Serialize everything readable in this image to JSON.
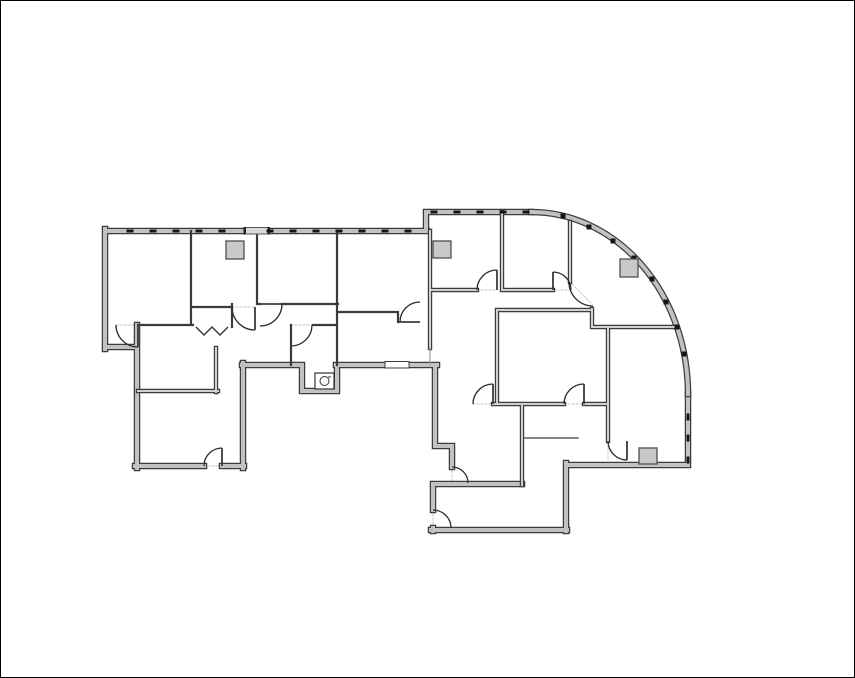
{
  "palette": {
    "background": "#ffffff",
    "image_border": "#000000",
    "wall_edge": "#3d3d3d",
    "wall_fill": "#c2c2c2",
    "partition_fill": "#d0d0d0",
    "wall_minor": "#3b3b3b",
    "hairline": "#3b3b3b",
    "light_wall": "#9b9b9b",
    "door": "#2b2b2b",
    "threshold": "#c6c6c6",
    "tick": "#161616",
    "column_fill": "#c9c9c9",
    "column_edge": "#4f4f4f",
    "fixture": "#333333",
    "recess_fill": "#d9d9d9",
    "recess_cap": "#222222"
  },
  "floorplan": {
    "canvas": {
      "width": 855,
      "height": 678
    },
    "walls_exterior": [
      [
        105,
        231,
        245,
        231
      ],
      [
        268,
        231,
        427,
        231
      ],
      [
        105,
        229,
        105,
        349
      ],
      [
        105,
        347,
        137,
        347
      ],
      [
        137,
        325,
        137,
        468
      ],
      [
        135,
        466,
        204,
        466
      ],
      [
        222,
        466,
        244,
        466
      ],
      [
        243,
        363,
        243,
        468
      ],
      [
        242,
        365,
        302,
        365
      ],
      [
        302,
        365,
        302,
        391
      ],
      [
        302,
        391,
        337,
        391
      ],
      [
        337,
        391,
        337,
        365
      ],
      [
        336,
        365,
        437,
        365
      ],
      [
        435,
        365,
        435,
        446
      ],
      [
        435,
        446,
        452,
        446
      ],
      [
        452,
        446,
        452,
        467
      ],
      [
        433,
        484,
        522,
        484
      ],
      [
        433,
        484,
        433,
        510
      ],
      [
        433,
        528,
        433,
        531
      ],
      [
        431,
        530,
        567,
        530
      ],
      [
        566,
        463,
        566,
        531
      ],
      [
        566,
        465,
        688,
        465
      ],
      [
        688,
        394,
        688,
        465
      ],
      [
        426,
        212,
        531,
        212
      ],
      [
        426,
        212,
        426,
        231
      ]
    ],
    "curve_path": "M531,212 A157,182 0 0 1 688,394",
    "walls_major": [
      [
        430,
        231,
        430,
        348
      ],
      [
        522,
        404,
        522,
        485
      ],
      [
        430,
        290,
        477,
        290
      ],
      [
        504,
        290,
        553,
        290
      ],
      [
        502,
        212,
        502,
        290
      ],
      [
        570,
        222,
        570,
        282
      ],
      [
        592,
        309,
        592,
        327
      ],
      [
        497,
        310,
        592,
        310
      ],
      [
        497,
        310,
        497,
        404
      ],
      [
        493,
        404,
        564,
        404
      ],
      [
        584,
        404,
        608,
        404
      ],
      [
        608,
        327,
        608,
        441
      ],
      [
        592,
        327,
        677,
        327
      ],
      [
        138,
        391,
        218,
        391
      ],
      [
        216,
        348,
        216,
        392
      ]
    ],
    "walls_minor": [
      [
        191,
        231,
        191,
        325
      ],
      [
        138,
        325,
        193,
        325
      ],
      [
        193,
        307,
        232,
        307
      ],
      [
        232,
        304,
        232,
        327
      ],
      [
        257,
        231,
        257,
        304
      ],
      [
        257,
        304,
        260,
        304
      ],
      [
        282,
        304,
        338,
        304
      ],
      [
        337,
        231,
        337,
        365
      ],
      [
        338,
        312,
        398,
        312
      ],
      [
        398,
        312,
        398,
        322
      ],
      [
        291,
        325,
        291,
        365
      ],
      [
        313,
        325,
        337,
        325
      ]
    ],
    "walls_hairline": [
      [
        525,
        438,
        578,
        438
      ]
    ],
    "walls_light": [
      [
        430,
        348,
        430,
        364
      ]
    ],
    "glass_panel": {
      "x": 385,
      "y": 361.5,
      "w": 24,
      "h": 6.5
    },
    "entry_recess": {
      "x": 245,
      "y": 227.5,
      "w": 23,
      "h": 6.5,
      "caps": [
        [
          243.5,
          227,
          2.5,
          7.5
        ],
        [
          267.5,
          227,
          2.5,
          7.5
        ]
      ]
    },
    "doors": [
      {
        "id": "door-room1-left",
        "cx": 138,
        "cy": 325,
        "r": 22,
        "a1": 180,
        "a2": 90,
        "leaf": [
          138,
          325,
          138,
          347
        ]
      },
      {
        "id": "door-closet-a",
        "cx": 255,
        "cy": 307,
        "r": 23,
        "a1": 180,
        "a2": 90,
        "leaf": [
          255,
          307,
          255,
          330
        ]
      },
      {
        "id": "door-closet-b",
        "cx": 260,
        "cy": 304,
        "r": 22,
        "a1": 0,
        "a2": 90,
        "leaf": [
          260,
          304,
          282,
          304
        ]
      },
      {
        "id": "door-restroom",
        "cx": 291,
        "cy": 325,
        "r": 21,
        "a1": 0,
        "a2": 90,
        "leaf": [
          291,
          325,
          291,
          346
        ]
      },
      {
        "id": "door-mid-office",
        "cx": 420,
        "cy": 322,
        "r": 20,
        "a1": 270,
        "a2": 180,
        "leaf": [
          399,
          322,
          420,
          322
        ]
      },
      {
        "id": "door-office-r1",
        "cx": 497,
        "cy": 290,
        "r": 20,
        "a1": 180,
        "a2": 270,
        "leaf": [
          497,
          290,
          497,
          270
        ]
      },
      {
        "id": "door-office-r2",
        "cx": 553,
        "cy": 290,
        "r": 18,
        "a1": 360,
        "a2": 270,
        "leaf": [
          553,
          290,
          553,
          272
        ]
      },
      {
        "id": "door-curved-room",
        "cx": 593,
        "cy": 282,
        "r": 24,
        "a1": 180,
        "a2": 90,
        "leaf": null
      },
      {
        "id": "door-center-room-w",
        "cx": 493,
        "cy": 404,
        "r": 20,
        "a1": 180,
        "a2": 270,
        "leaf": [
          493,
          404,
          493,
          384
        ]
      },
      {
        "id": "door-center-room-e",
        "cx": 584,
        "cy": 404,
        "r": 20,
        "a1": 180,
        "a2": 270,
        "leaf": [
          584,
          404,
          584,
          384
        ]
      },
      {
        "id": "door-se-room",
        "cx": 627,
        "cy": 441,
        "r": 19,
        "a1": 180,
        "a2": 90,
        "leaf": [
          627,
          441,
          627,
          460
        ]
      },
      {
        "id": "door-sw-room",
        "cx": 222,
        "cy": 466,
        "r": 18,
        "a1": 180,
        "a2": 270,
        "leaf": [
          222,
          466,
          222,
          448
        ]
      },
      {
        "id": "door-south-room-w",
        "cx": 433,
        "cy": 528,
        "r": 18,
        "a1": 270,
        "a2": 360,
        "leaf": null
      },
      {
        "id": "door-south-vest",
        "cx": 452,
        "cy": 483,
        "r": 16,
        "a1": 270,
        "a2": 360,
        "leaf": null
      }
    ],
    "bifold_points": "196,327 204,335 212,327 220,335 228,327",
    "ticks_h": [
      [
        130,
        231
      ],
      [
        153,
        231
      ],
      [
        176,
        231
      ],
      [
        199,
        231
      ],
      [
        222,
        231
      ],
      [
        270,
        231
      ],
      [
        293,
        231
      ],
      [
        316,
        231
      ],
      [
        339,
        231
      ],
      [
        362,
        231
      ],
      [
        385,
        231
      ],
      [
        408,
        231
      ],
      [
        434,
        212
      ],
      [
        457,
        212
      ],
      [
        480,
        212
      ],
      [
        503,
        212
      ],
      [
        526,
        212
      ]
    ],
    "ticks_v": [
      [
        688,
        417
      ],
      [
        688,
        438
      ],
      [
        688,
        460
      ]
    ],
    "ticks_c": [
      [
        563,
        216
      ],
      [
        589,
        227
      ],
      [
        613,
        241
      ],
      [
        634,
        258
      ],
      [
        652,
        279
      ],
      [
        666,
        302
      ],
      [
        677,
        327
      ],
      [
        684,
        354
      ]
    ],
    "columns": [
      [
        226,
        241,
        18,
        18
      ],
      [
        433,
        241,
        18,
        17
      ],
      [
        620,
        259,
        18,
        18
      ],
      [
        639,
        448,
        18,
        16
      ]
    ],
    "sink": {
      "x": 315,
      "y": 373,
      "w": 19,
      "h": 16,
      "cx": 324.5,
      "cy": 381,
      "r": 4.5
    },
    "thresholds": [
      [
        116,
        325,
        138,
        325
      ],
      [
        232,
        307,
        255,
        307
      ],
      [
        260,
        304,
        282,
        304
      ],
      [
        291,
        325,
        313,
        325
      ],
      [
        477,
        290,
        497,
        290
      ],
      [
        553,
        290,
        571,
        290
      ],
      [
        572,
        284,
        592,
        304
      ],
      [
        473,
        404,
        493,
        404
      ],
      [
        564,
        404,
        584,
        404
      ],
      [
        608,
        441,
        608,
        461
      ],
      [
        204,
        466,
        222,
        466
      ],
      [
        399,
        322,
        420,
        322
      ],
      [
        433,
        510,
        433,
        528
      ],
      [
        452,
        467,
        452,
        483
      ]
    ]
  }
}
